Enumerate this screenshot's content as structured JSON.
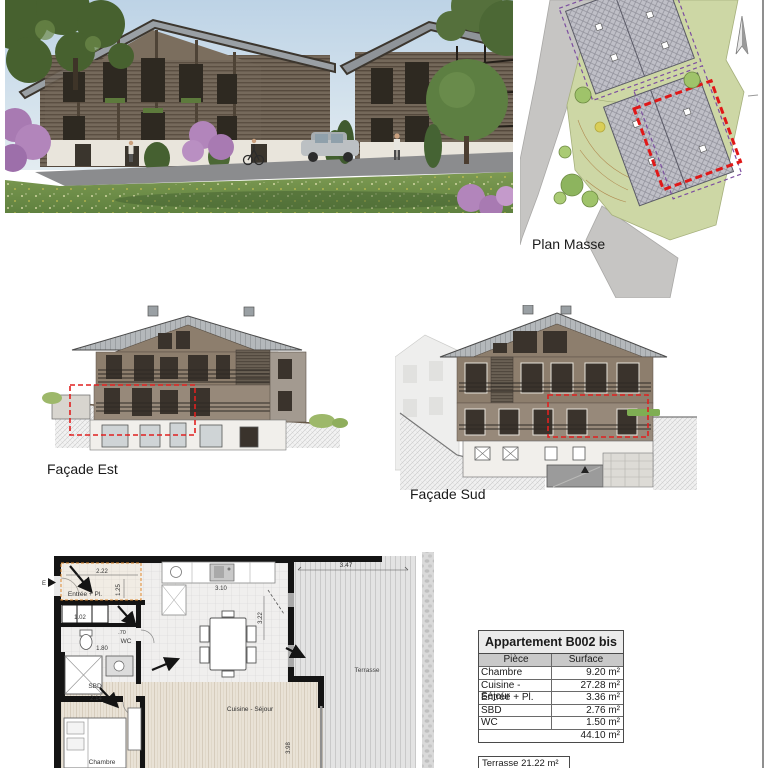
{
  "site_plan": {
    "label": "Plan Masse"
  },
  "facade_est": {
    "label": "Façade Est"
  },
  "facade_sud": {
    "label": "Façade Sud"
  },
  "floor_plan": {
    "labels": {
      "entree": "Entrée + Pl.",
      "wc": "WC",
      "sbd": "SBD",
      "chambre": "Chambre",
      "cuisine": "Cuisine - Séjour",
      "terrasse": "Terrasse",
      "entry_mark": "E"
    },
    "dims": {
      "d222": "2.22",
      "d125": "1.25",
      "d102": "1.02",
      "d70": ".70",
      "d180": "1.80",
      "d214": "2.14",
      "d310": "3.10",
      "d322": "3.22",
      "d398": "3.98",
      "d347": "3.47"
    }
  },
  "apartment_table": {
    "title": "Appartement B002 bis",
    "columns": [
      "Pièce",
      "Surface"
    ],
    "rows": [
      [
        "Chambre",
        "9.20 m²"
      ],
      [
        "Cuisine - Séjour",
        "27.28 m²"
      ],
      [
        "Entrée + Pl.",
        "3.36 m²"
      ],
      [
        "SBD",
        "2.76 m²"
      ],
      [
        "WC",
        "1.50 m²"
      ]
    ],
    "total": "44.10 m²",
    "terrace_note": "Terrasse 21.22 m²"
  },
  "colors": {
    "highlight_red": "#e02020",
    "entry_orange": "#e08a30",
    "plan_green": "#cdd7a5",
    "roof_gray": "#b4b8bb",
    "wood_dark": "#6e6254",
    "wood_mid": "#8d7e6d",
    "cream": "#f1efeb"
  }
}
